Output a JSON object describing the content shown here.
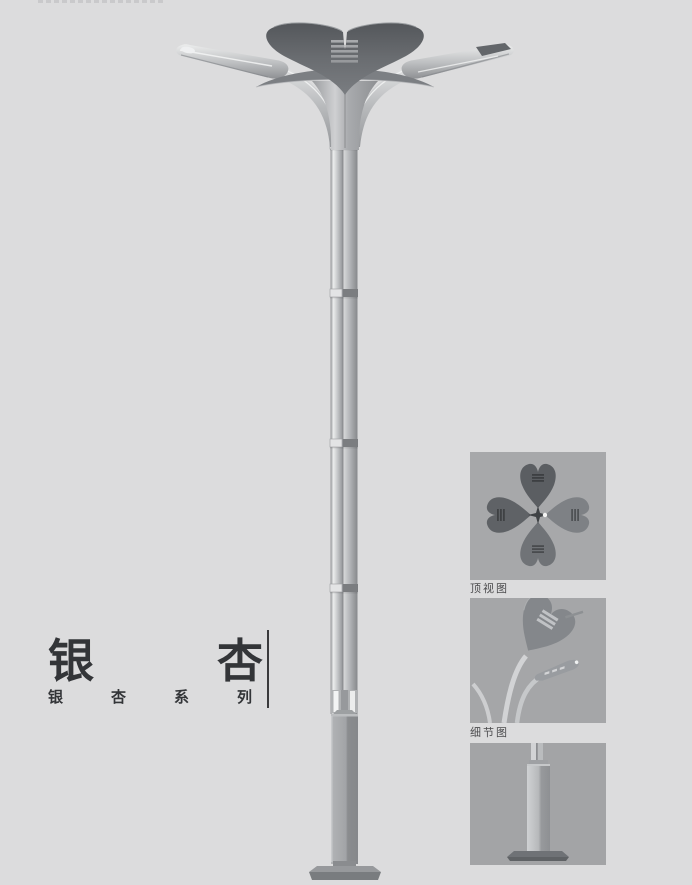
{
  "product": {
    "title_chars": [
      "银",
      "杏"
    ],
    "series_chars": [
      "银",
      "杏",
      "系",
      "列"
    ]
  },
  "insets": {
    "top_view": {
      "label": "顶视图"
    },
    "detail_view": {
      "label": "细节图"
    },
    "base_view": {
      "label": ""
    }
  },
  "illustration": {
    "subject": "ginkgo-series-double-arm-street-lamp",
    "pole_joint_count": 4,
    "arm_count": 2
  },
  "colors": {
    "page_bg": "#dcdcdd",
    "inset_bg": "#a6a7a9",
    "text": "#333538",
    "crown_dark": "#5d6064",
    "metal_light": "#c9cbcd",
    "metal_mid": "#a8aaad",
    "base_dark": "#8a8c8f"
  }
}
